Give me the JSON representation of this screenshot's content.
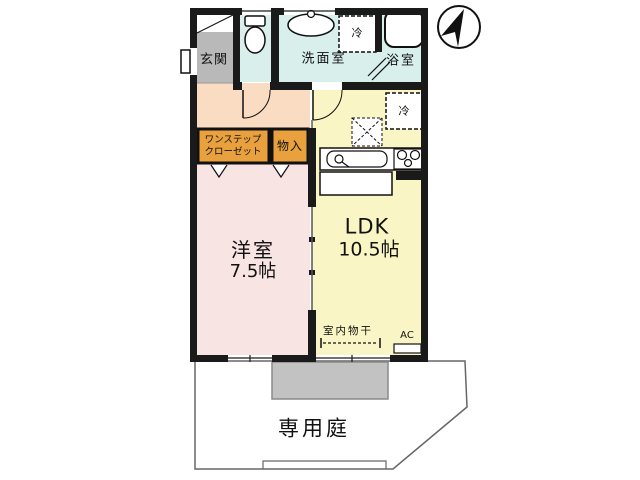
{
  "labels": {
    "genkan": "玄関",
    "washroom": "洗面室",
    "bathroom": "浴室",
    "laundry_box": "冷",
    "fridge_box": "冷",
    "closet_line1": "ワンステップ",
    "closet_line2": "クローゼット",
    "storage": "物入",
    "western_room": "洋室",
    "western_room_size": "7.5帖",
    "ldk": "LDK",
    "ldk_size": "10.5帖",
    "indoor_drying": "室内物干",
    "ac": "AC",
    "private_garden": "専用庭"
  },
  "colors": {
    "wall": "#1a1a1a",
    "wet_rooms": "#d8efec",
    "hallway": "#f9dcc1",
    "closet": "#e8a13c",
    "western_room": "#f8e4e2",
    "ldk": "#f9f5c4",
    "genkan_floor": "#b9b9b9",
    "terrace": "#c2c2c2"
  },
  "icons": [
    "north-arrow-icon",
    "toilet-icon",
    "washbasin-icon",
    "bathtub-icon",
    "kitchen-sink-icon",
    "stove-icon",
    "door-swing-icon"
  ]
}
